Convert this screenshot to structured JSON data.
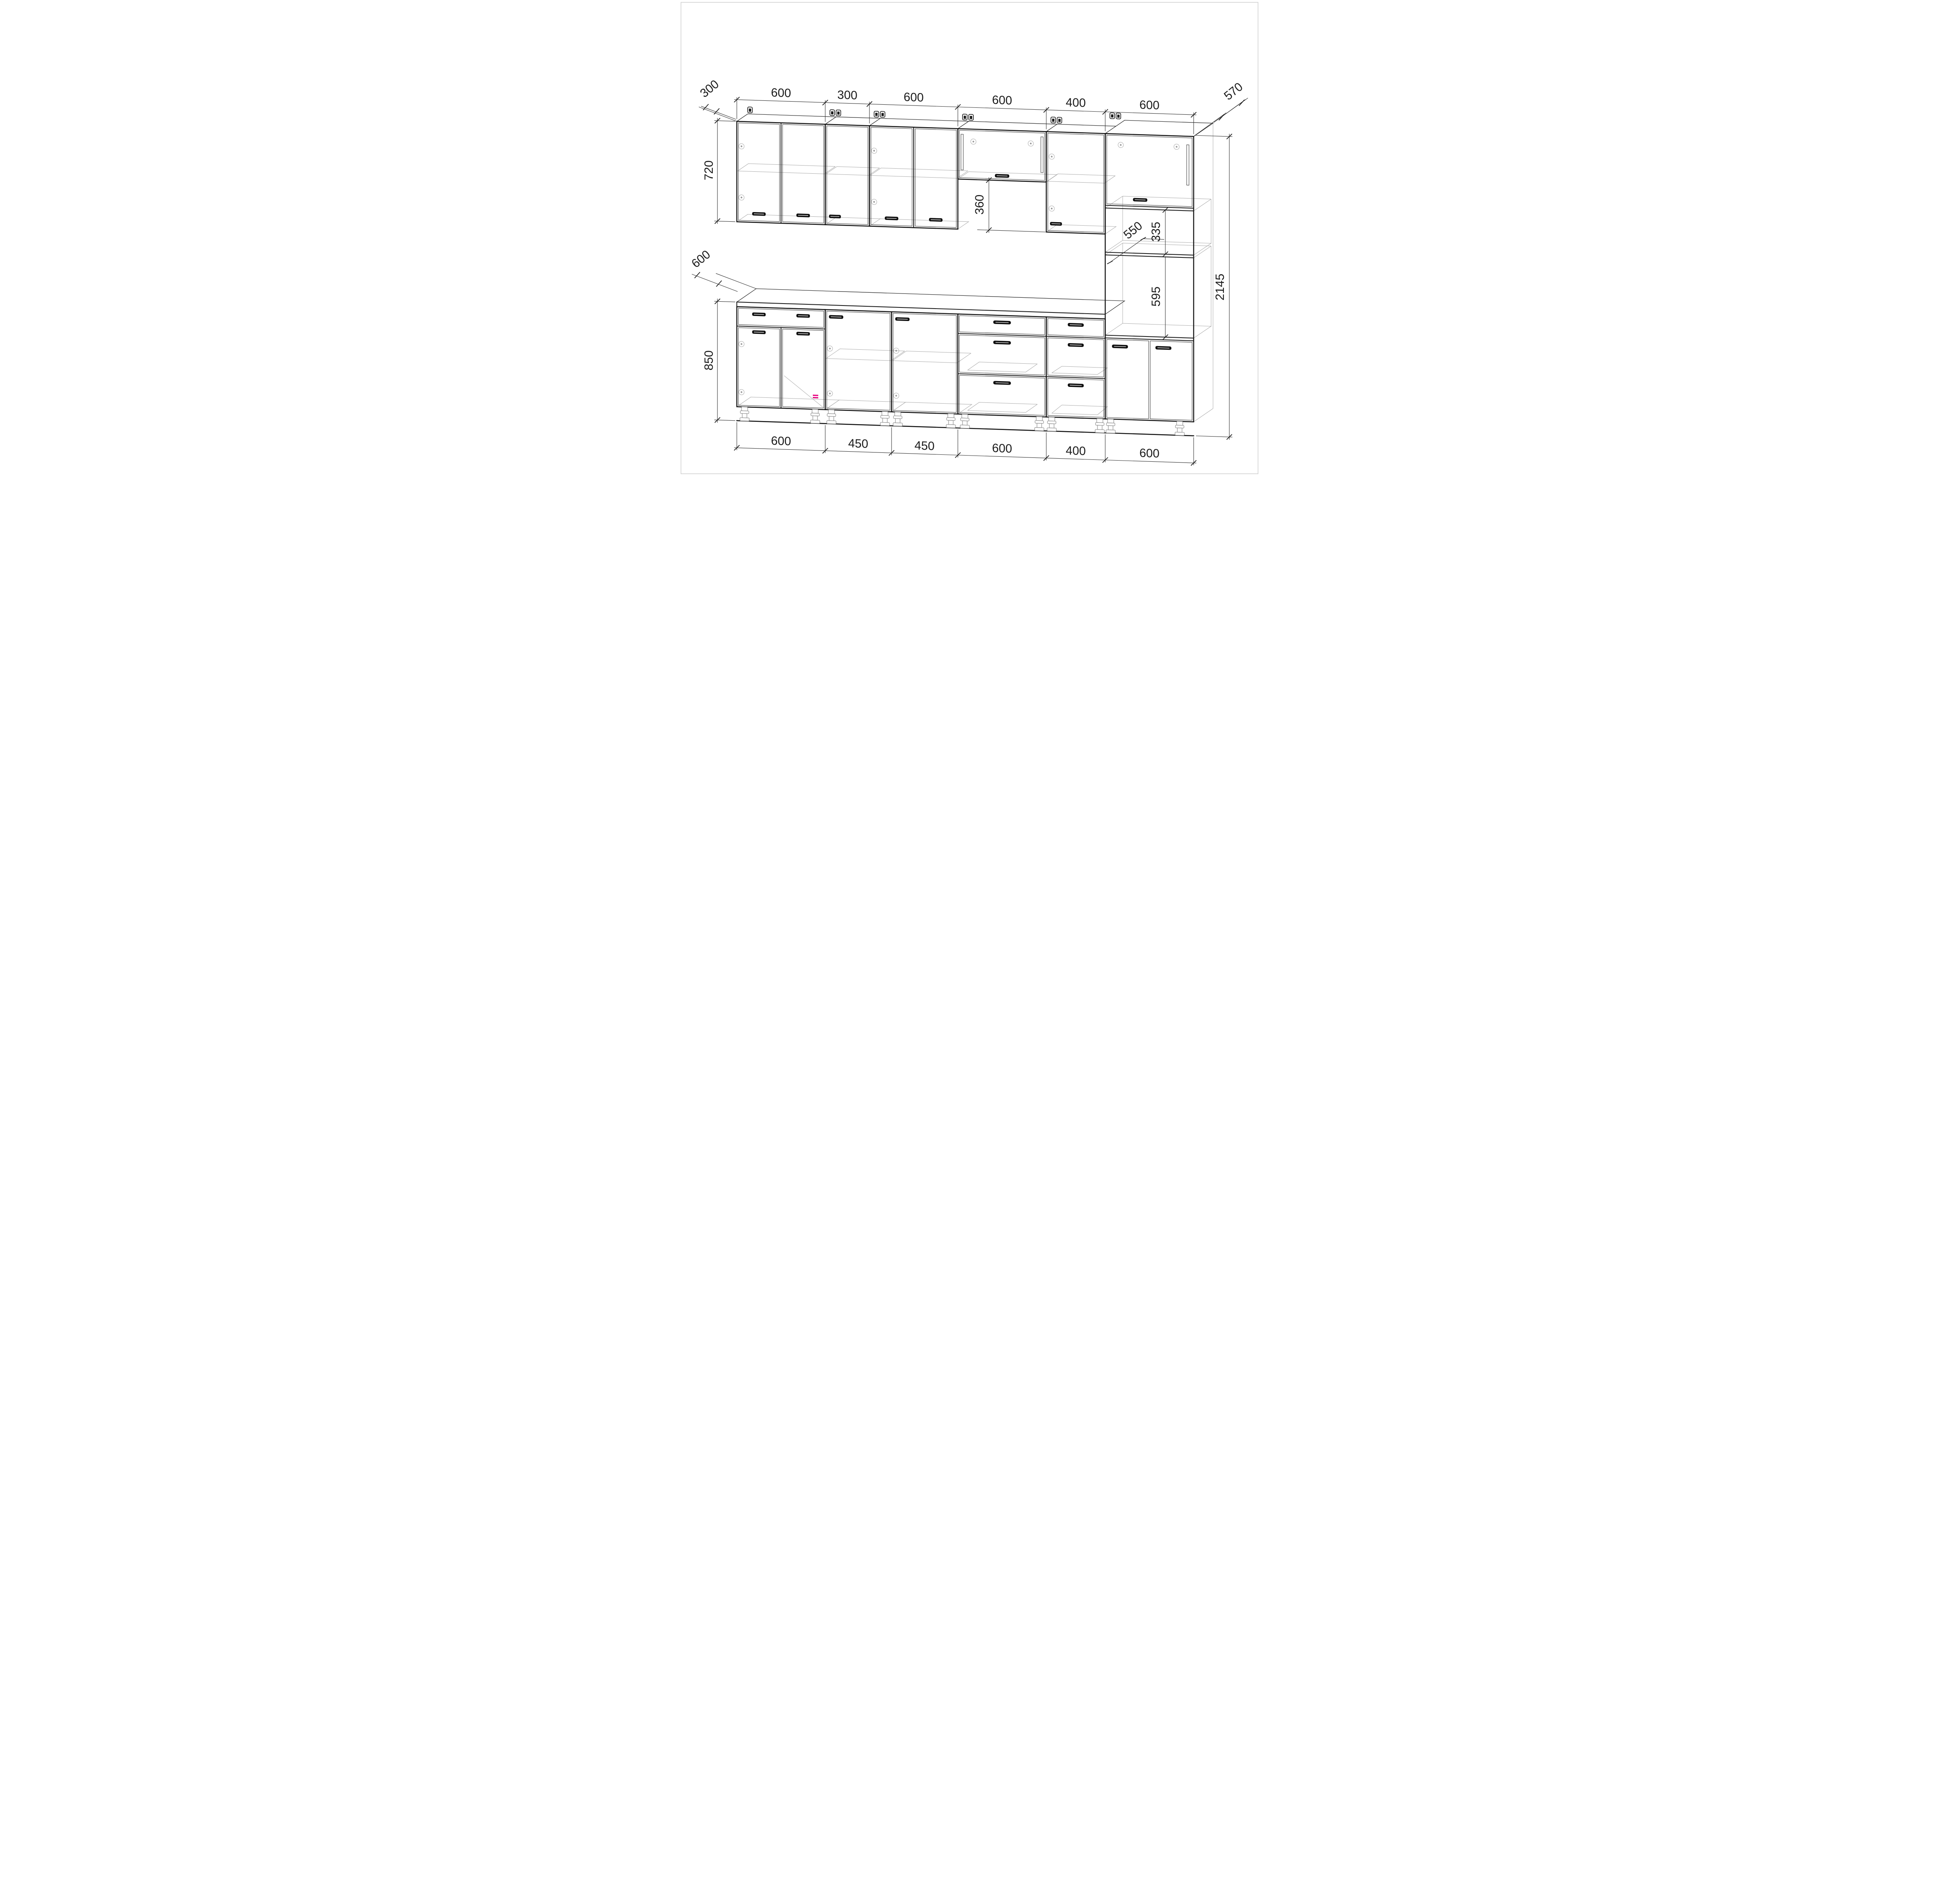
{
  "drawing": {
    "type": "kitchen-cabinet-assembly-wireframe",
    "units": "mm",
    "dims": {
      "top": [
        "600",
        "300",
        "600",
        "600",
        "400",
        "600"
      ],
      "bottom": [
        "600",
        "450",
        "450",
        "600",
        "400",
        "600"
      ],
      "left": {
        "wall_depth": "300",
        "wall_height": "720",
        "base_depth": "600",
        "base_height": "850"
      },
      "center": {
        "hood_offset": "360"
      },
      "right": {
        "tall_depth": "570",
        "upper_niche": "335",
        "inner_depth": "550",
        "oven_niche": "595",
        "total_height": "2145"
      }
    },
    "colors": {
      "line": "#141414",
      "wireframe": "#a8a8a8",
      "dimension": "#1c1c1c",
      "accent": "#e6007e",
      "frame": "#c9c9c9",
      "background": "#ffffff"
    }
  }
}
